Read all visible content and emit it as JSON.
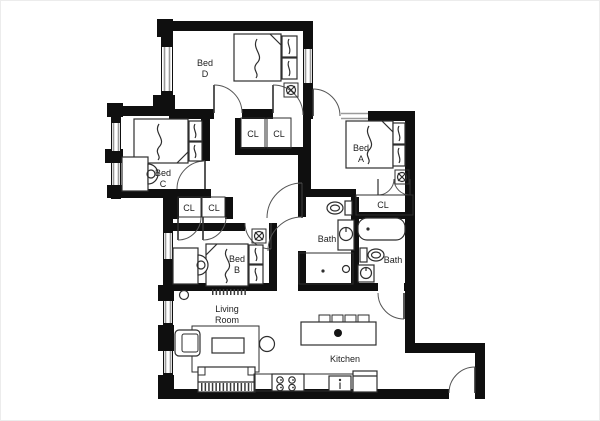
{
  "title": "Apartment floor plan",
  "rooms": {
    "bed_d": {
      "label": "Bed D",
      "lines": [
        "Bed",
        "D"
      ]
    },
    "bed_c": {
      "label": "Bed C",
      "lines": [
        "Bed",
        "C"
      ]
    },
    "bed_a": {
      "label": "Bed A",
      "lines": [
        "Bed",
        "A"
      ]
    },
    "bed_b": {
      "label": "Bed B",
      "lines": [
        "Bed",
        "B"
      ]
    },
    "bath_left": {
      "label": "Bath"
    },
    "bath_right": {
      "label": "Bath"
    },
    "living_room": {
      "label": "Living Room",
      "lines": [
        "Living",
        "Room"
      ]
    },
    "kitchen": {
      "label": "Kitchen"
    }
  },
  "closets": {
    "labels": [
      "CL",
      "CL",
      "CL",
      "CL",
      "CL"
    ]
  },
  "fixtures": [
    "double-bed-d",
    "double-bed-c",
    "double-bed-b",
    "double-bed-a",
    "pillows",
    "ceiling-fan-icon",
    "desk-with-chair",
    "desk-with-chair",
    "toilet",
    "toilet",
    "pedestal-sink",
    "pedestal-sink",
    "bathtub",
    "shower-pan",
    "kitchen-island-with-stools",
    "island-sink",
    "range-4-burner",
    "dishwasher",
    "refrigerator",
    "sofa",
    "armchair",
    "coffee-table",
    "round-side-table",
    "area-rug",
    "radiator",
    "smoke-detector",
    "door-swing-arcs",
    "window-segments"
  ],
  "colors": {
    "wall": "#0f0f0f",
    "furniture_line": "#2e2e2e",
    "door_arc": "#555555",
    "window": "#9a9a9a",
    "label_text": "#222222",
    "background": "#ffffff"
  }
}
